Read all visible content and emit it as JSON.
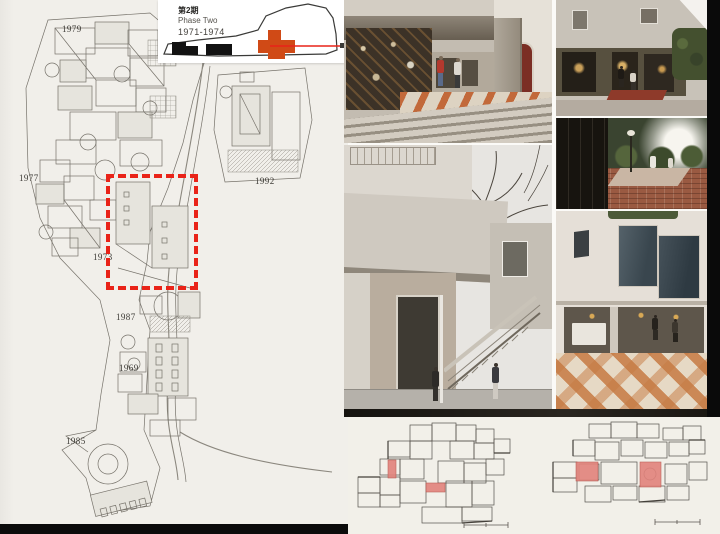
{
  "inset": {
    "phase_label_jp": "第2期",
    "phase_label_en": "Phase Two",
    "phase_years": "1971-1974"
  },
  "site_labels": {
    "y1979": "1979",
    "y1977": "1977",
    "y1973": "1973",
    "y1987": "1987",
    "y1969": "1969",
    "y1985": "1985",
    "y1992": "1992"
  },
  "colors": {
    "highlight_dash_red": "#e92318",
    "phase_orange": "#d04a16",
    "inset_red_line": "#e92318",
    "plan_room_red": "#e2837c",
    "paper": "#f1efea"
  }
}
